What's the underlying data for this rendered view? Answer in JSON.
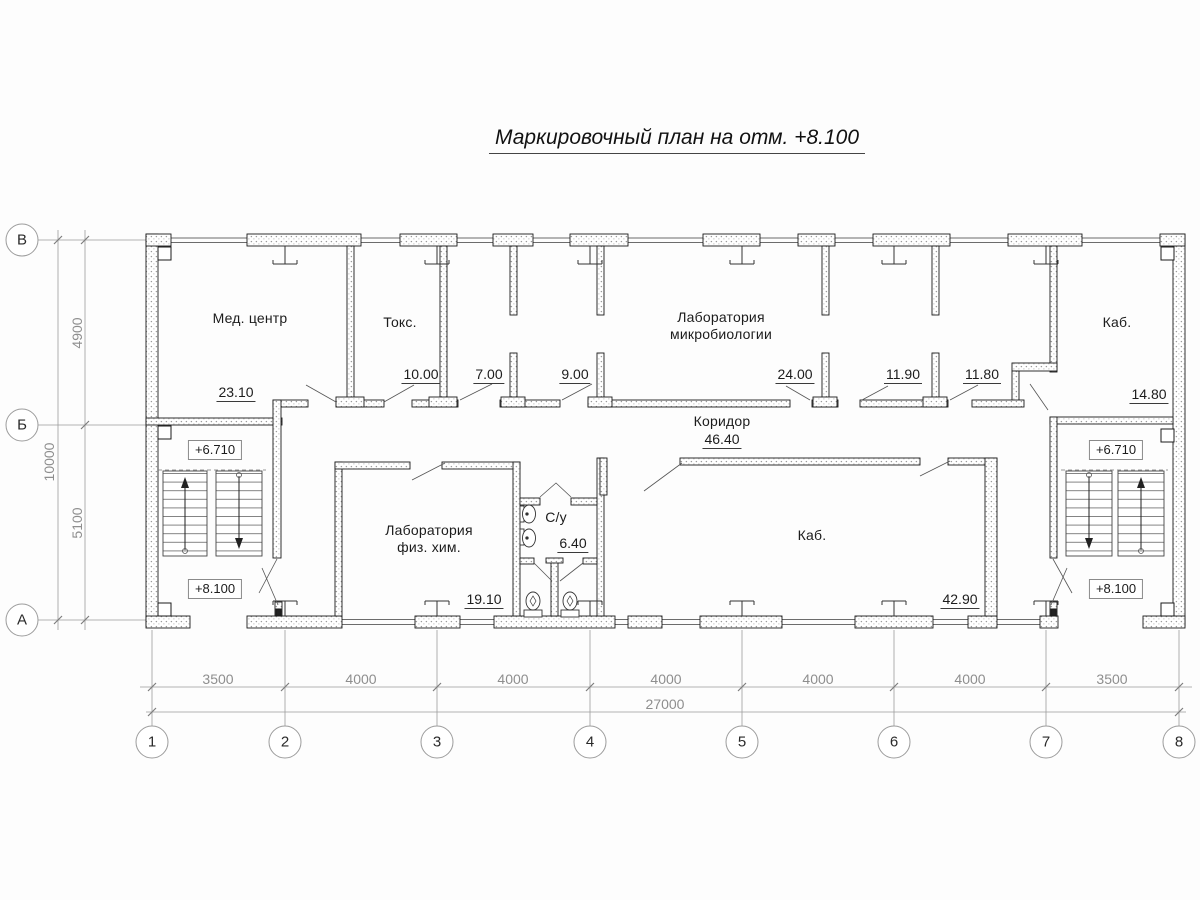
{
  "title": "Маркировочный план на отм. +8.100",
  "rooms": {
    "med_center": {
      "name": "Мед. центр",
      "area": "23.10"
    },
    "toks": {
      "name": "Токс.",
      "area": "10.00"
    },
    "room_7": {
      "area": "7.00"
    },
    "room_9": {
      "area": "9.00"
    },
    "microbio": {
      "name_line1": "Лаборатория",
      "name_line2": "микробиологии",
      "area": "24.00"
    },
    "room_11_90": {
      "area": "11.90"
    },
    "room_11_80": {
      "area": "11.80"
    },
    "kab_top": {
      "name": "Каб.",
      "area": "14.80"
    },
    "corridor": {
      "name": "Коридор",
      "area": "46.40"
    },
    "fiz_him": {
      "name_line1": "Лаборатория",
      "name_line2": "физ. хим.",
      "area": "19.10"
    },
    "su": {
      "name": "С/у",
      "area": "6.40"
    },
    "kab_bottom": {
      "name": "Каб.",
      "area": "42.90"
    }
  },
  "elevations": {
    "left_upper": "+6.710",
    "left_lower": "+8.100",
    "right_upper": "+6.710",
    "right_lower": "+8.100"
  },
  "grid": {
    "rows": [
      "В",
      "Б",
      "А"
    ],
    "columns": [
      "1",
      "2",
      "3",
      "4",
      "5",
      "6",
      "7",
      "8"
    ]
  },
  "dimensions": {
    "bays": [
      "3500",
      "4000",
      "4000",
      "4000",
      "4000",
      "4000",
      "3500"
    ],
    "total_width": "27000",
    "row_segments": [
      "4900",
      "5100"
    ],
    "total_height": "10000"
  }
}
